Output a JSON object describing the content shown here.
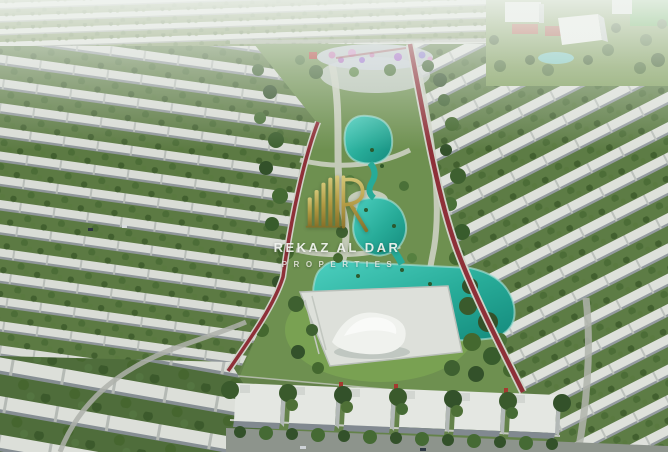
{
  "scene": {
    "type": "aerial-3d-render",
    "subject": "Residential villa community masterplan with a central linear park, winding turquoise lagoon, red jogging track, playground and curved rows of white villas among dense trees",
    "areas": {
      "central_park": "landscaped park strip with lagoon, palms and paths",
      "lagoon": "winding turquoise swimming lagoon",
      "jogging_track": "dark red running track along both park edges",
      "wave_pavilion": "white wave-shaped pavilion on a paved plaza",
      "playground": "colorful kids playground at the top of the park",
      "community_center": "white community buildings with red sports courts and pool, top right",
      "sports_field": "bright green field, top right corner",
      "villa_rows": "curved rows of white villas with street trees",
      "foreground_villas": "large flat-roof villas along the bottom street"
    },
    "colors": {
      "lagoon_teal": "#2aa896",
      "track_red": "#8e3038",
      "villa_white": "#e4e7e2",
      "tree_green_dark": "#33512a",
      "tree_green_light": "#6b8f4e",
      "lawn_green": "#6e9050",
      "playground_pink": "#c77fb5",
      "haze_white": "#eef2ee"
    }
  },
  "watermark": {
    "brand_name": "REKAZ AL DAR",
    "brand_tagline": "PROPERTIES",
    "logo": "rekaz-monogram-icon",
    "logo_gold": "#b59b42",
    "text_color": "#f2f4f0"
  }
}
